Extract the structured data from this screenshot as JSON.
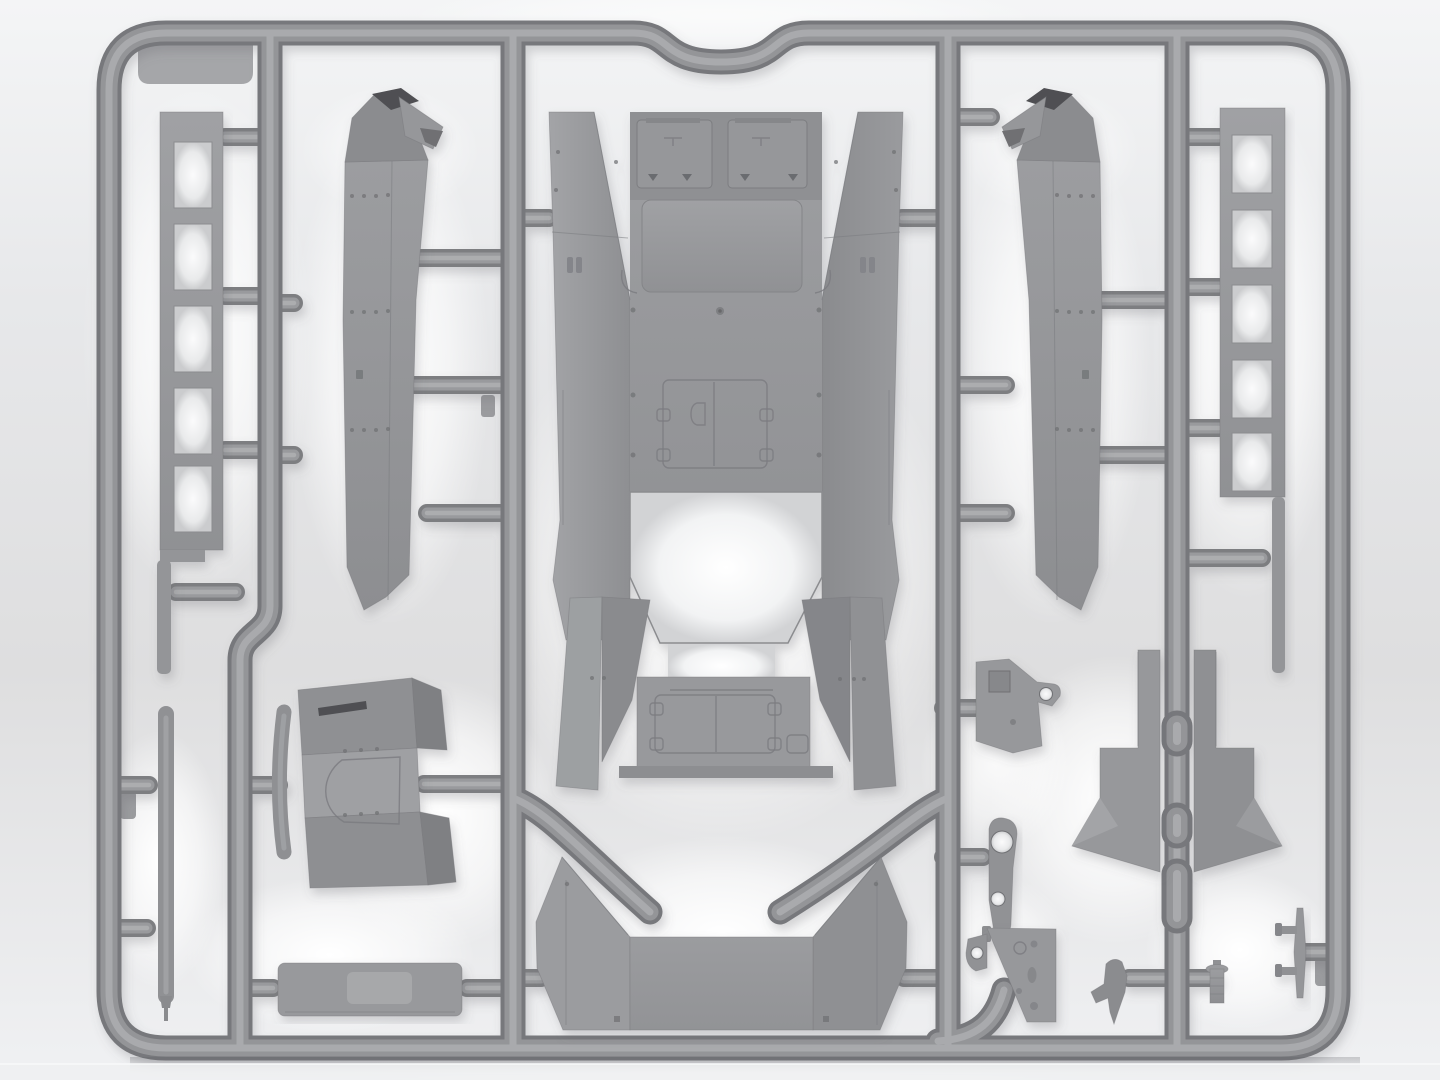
{
  "scene": {
    "description": "Gray injection-molded plastic model kit sprue with armored vehicle hull parts on a light studio background",
    "text_visible": "none"
  },
  "colors": {
    "bg-top": "#f4f5f6",
    "bg-bottom": "#f0f1f3",
    "tube-dark": "#77787b",
    "tube-mid": "#949598",
    "tube-light": "#a9aaad",
    "stub-dark": "#7d7e81",
    "stub-mid": "#999a9d",
    "stub-light": "#acadaf",
    "part-base": "#97989b",
    "part-light": "#a4a5a8",
    "part-mid": "#8e8f92",
    "part-dark": "#7f8083",
    "part-deep": "#4f5053",
    "seam": "#7a7b7f",
    "rivet": "#6f7073",
    "glow": "#ffffff"
  },
  "parts": {
    "sprue_frame": {
      "label": "sprue runner frame with top gate notch"
    },
    "ladder_left": {
      "label": "slotted frame part, 5 openings, top left",
      "holes": 5
    },
    "ladder_right": {
      "label": "slotted frame part, 5 openings, top right",
      "holes": 5
    },
    "hull_side_left": {
      "label": "left hull side panel with angled roof cap"
    },
    "hull_side_right": {
      "label": "right hull side panel with angled roof cap"
    },
    "hull_center": {
      "label": "main hull body with roof hatches, doors and open bay"
    },
    "belly_plate": {
      "label": "v-shaped hull belly plate with side wings"
    },
    "seat_plate": {
      "label": "backrest-like plate with u-shaped recess"
    },
    "rod_short": {
      "label": "short rod part beside seat plate"
    },
    "rod_long": {
      "label": "long tapered rod part, lower left"
    },
    "box_part": {
      "label": "rectangular box part with raised lid plate"
    },
    "bracket": {
      "label": "angled bracket with square and round holes"
    },
    "lever": {
      "label": "lever arm with two round holes"
    },
    "gusset": {
      "label": "triangular gusset plate with holes"
    },
    "wing_pair_left": {
      "label": "left angled wing bracket flanking runner"
    },
    "wing_pair_right": {
      "label": "right angled wing bracket flanking runner"
    },
    "periscope": {
      "label": "small periscope-shaped part"
    },
    "cylinder": {
      "label": "small ribbed cylinder part"
    },
    "blade": {
      "label": "thin blade part with two pegs, bottom right"
    }
  }
}
